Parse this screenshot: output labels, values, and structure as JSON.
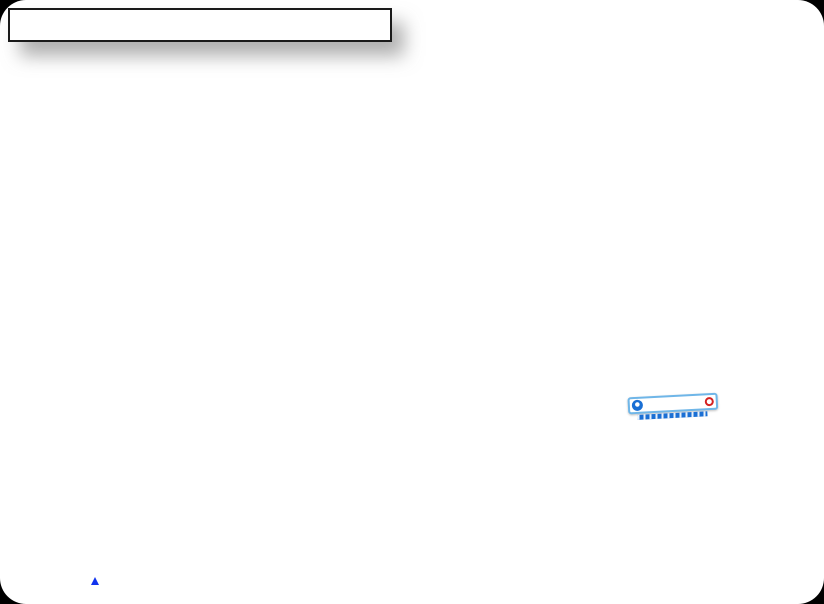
{
  "table": {
    "title": "落地扣件式外架材料统计表",
    "headers": [
      "材料名称",
      "用途",
      "规格",
      "单位",
      "数量"
    ],
    "pipe_material": "48×3.5钢管",
    "groups": [
      {
        "purpose": "小横杆",
        "rows": [
          [
            "1.4m",
            "m",
            "1230"
          ]
        ]
      },
      {
        "purpose": "斜撑",
        "rows": [
          [
            "2.0m",
            "根",
            "40"
          ],
          [
            "3.0m",
            "根",
            "51"
          ],
          [
            "4.0m",
            "根",
            "87"
          ],
          [
            "5.0m",
            "根",
            "49"
          ],
          [
            "6.0m",
            "根",
            "311"
          ]
        ]
      },
      {
        "purpose": "横向斜撑",
        "rows": [
          [
            "1.0m",
            "根",
            "1"
          ],
          [
            "1.5m",
            "根",
            "3"
          ],
          [
            "1.9m",
            "根",
            "616"
          ],
          [
            "2.0m",
            "根",
            "160"
          ],
          [
            "2.3m",
            "根",
            "224"
          ]
        ]
      },
      {
        "purpose": "",
        "rows": [
          [
            "2.6m",
            "根",
            "120"
          ],
          [
            "3.0m",
            "根",
            "404"
          ],
          [
            "3.5m",
            "根",
            "231"
          ],
          [
            "5.0m",
            "根",
            "242"
          ],
          [
            "6.0m",
            "根",
            "475"
          ]
        ]
      },
      {
        "purpose": "立杆",
        "rows": [
          [
            "3.0m",
            "根",
            "156"
          ],
          [
            "6.0m",
            "根",
            "786"
          ]
        ]
      },
      {
        "purpose": "合计",
        "is_total": true,
        "rows": [
          [
            "",
            "m",
            "18640"
          ]
        ]
      }
    ],
    "extra_sections": [
      {
        "purpose": "架体钢管间的连接",
        "rows": [
          {
            "material": "底部垫板",
            "spec": "底部垫板",
            "unit": "m",
            "qty": "36"
          },
          {
            "material": "扣件",
            "spec": "对接扣件",
            "unit": "个",
            "qty": "2064"
          }
        ]
      },
      {
        "purpose": "",
        "rows": [
          {
            "material": "撑脚板",
            "spec": "撑脚板",
            "unit": "m",
            "qty": "18"
          },
          {
            "material": "脚手板",
            "spec": "脚手板",
            "unit": "m²",
            "qty": "950"
          }
        ]
      },
      {
        "purpose": "合计",
        "rows": [
          {
            "material": "钢丝绳",
            "spec": "",
            "unit": "m",
            "qty": ""
          },
          {
            "material": "防尘网",
            "spec": "防尘网",
            "unit": "m²",
            "qty": "3314",
            "boxed": true
          }
        ]
      }
    ]
  },
  "scene": {
    "sign_text": "安全通道",
    "axis_label": "Z",
    "colors": {
      "mesh_green": "#9bd795",
      "deck_green": "#c5ecc0",
      "stripe_red": "#e02222",
      "brace_red": "#8c1313",
      "pole_gray": "#a8a8a8",
      "toeboard_gold": "#ad8c30",
      "material_blue": "#1f3fff",
      "purpose_green": "#1e8a1e",
      "sign_red": "#e01818",
      "sign_blue": "#1a6fd4"
    }
  }
}
